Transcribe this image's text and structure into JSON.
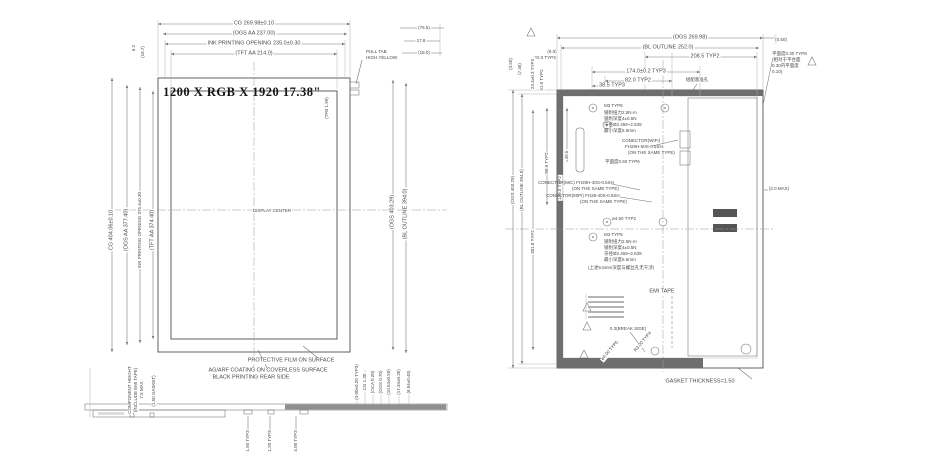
{
  "meta": {
    "bg_color": "#ffffff",
    "line_color": "#555555",
    "text_color": "#4a4a4a",
    "dark_band_color": "#6e6e6e"
  },
  "left_view": {
    "title": "1200 X RGB X 1920  17.38\"",
    "display_center": "DISPLAY CENTER",
    "top_dims": [
      "CG 269.98±0.10",
      "(OGS AA 237.00)",
      "INK PRINTING OPENING 235.0±0.30",
      "(TFT AA 214.0)"
    ],
    "top_right_dims": [
      "(76.5)",
      "17.8",
      "(18.0)"
    ],
    "top_left_dims": [
      "6.2",
      "(18.7)"
    ],
    "left_dims": [
      "CG 404.06±0.10",
      "(OGS AA 377.40)",
      "INK PRINTING OPENING 375.4±0.30",
      "(TFT AA 374.40)"
    ],
    "right_dims": [
      "(OGS 403.29)",
      "(BL OUTLINE 394.0)"
    ],
    "edge_note": "(TFB 1.99)",
    "corner_note": [
      "PULL TAB",
      "HIGH YELLOW"
    ],
    "note_film": "PROTECTIVE FILM ON SURFACE",
    "note_coating": [
      "AG/ARF COATING ON COVERLESS SURFACE",
      "BLACK PRINTING REAR SIDE"
    ],
    "component_note": [
      "COMPONENT HEIGHT",
      "(INCLUDE EMI TAPE)",
      "7.5 MAX"
    ],
    "gasket_note": "(1.50 GASKET)",
    "thickness_dims": [
      "(3.00±0.20 TYP3)",
      "CG 1.30",
      "(OCA 0.20)",
      "(OGS 0.70)",
      "(10.54±0.50)",
      "(17.34±0.35)",
      "(6.94±0.40)"
    ],
    "profile_dims": [
      "1.50 TYP3",
      "1.20 TYP3",
      "4.00 TYP3"
    ]
  },
  "right_view": {
    "top_dims": [
      "(OGS 269.98)",
      "(BL OUTLINE 252.0)",
      "208.5 TYP2",
      "174.0±0.2 TYP3",
      "82.0 TYP2",
      "38.5 TYP3"
    ],
    "top_small": [
      "(9.0)",
      "22.0 TYP3",
      "23.4±0.3 TYP3",
      "41.0 TYP2",
      "(3.50)",
      "(7.46)",
      "(0.50)"
    ],
    "left_dims": [
      "(OGS 403.29)",
      "(BL OUTLINE 394.0)",
      "381.8 TYP2",
      "80.9 TYP2",
      "139.0 TYP2",
      "49.5"
    ],
    "flatness_note": [
      "平面度0.30 TYP8",
      "(相对于平台面",
      "0.30内平面度",
      "0.10)"
    ],
    "datum_note": "组配基准孔",
    "screw_note1": [
      "M3 TYP8",
      "锁附扭力2.5N·m",
      "锁附深度4±0.5N",
      "牙径Ø2.459~2.639",
      "最小深度6.5mm"
    ],
    "conn_wifi": [
      "CONECTOR(WIFI)",
      "FH28H-50S-0.5SH",
      "(ON THE SAME TYPE)"
    ],
    "flat_inner": "平面度0.50 TYP6",
    "conn_mic": [
      "CONECTOR(MIC) FH28H-30S-0.5SH",
      "(ON THE SAME TYPE)"
    ],
    "conn_mipi": [
      "CONECTOR(MIPI) FH28-40S-0.5SH",
      "(ON THE SAME TYPE)"
    ],
    "hole_dim": "ø4.50 TYP2",
    "screw_note2": [
      "M3 TYP6",
      "锁附扭力2.5N·m",
      "锁附深度4±0.5N",
      "牙径Ø2.459~2.639",
      "最小深度6.5mm",
      "(上述6.5mm深度与螺丝孔无干涉)"
    ],
    "emi_tape": "EMI TAPE",
    "break_side": "0.3(BREAK SIDE)",
    "diag_dims": [
      "ø4.00 TYP6",
      "R3.00 TYP4"
    ],
    "gasket": "GASKET THICKNESS=1.50",
    "max_note": "(2.0 MAX)"
  }
}
